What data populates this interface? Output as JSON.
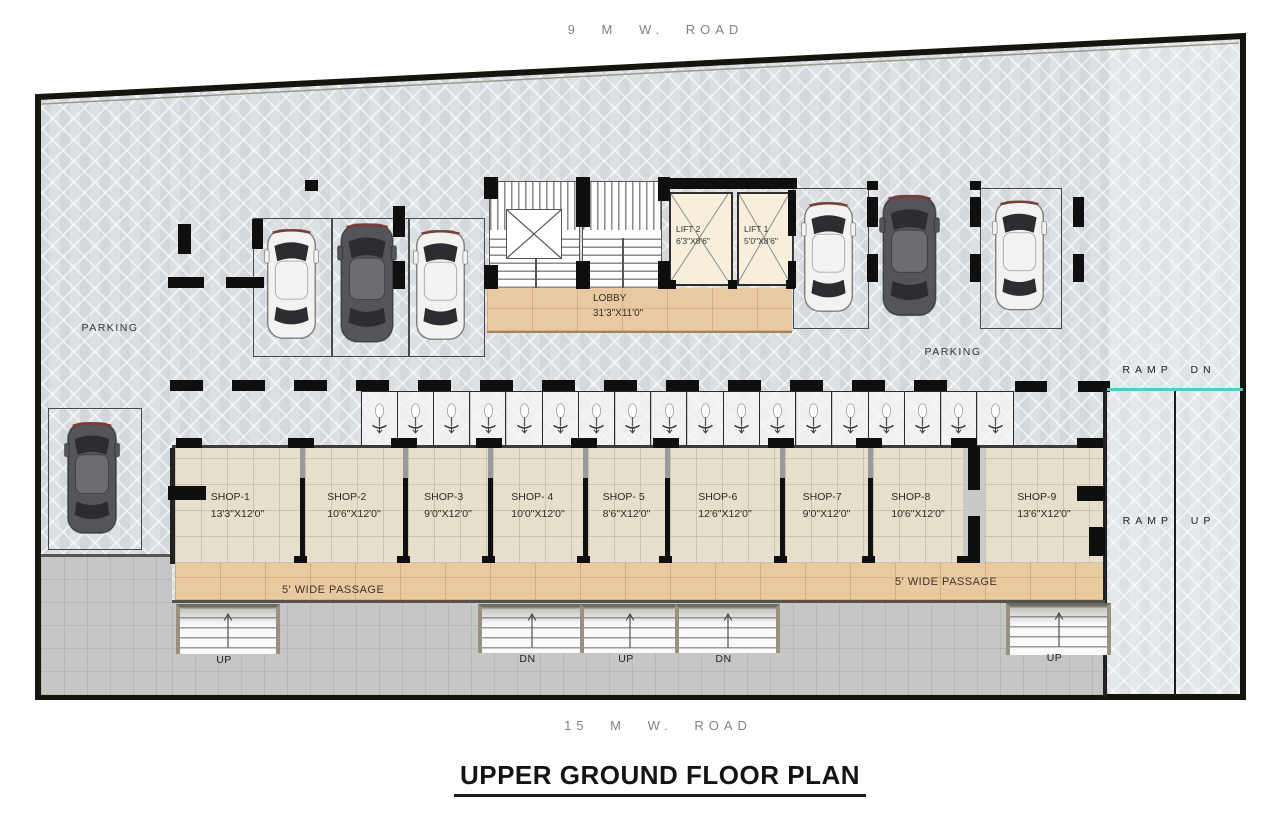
{
  "plan": {
    "title": "UPPER GROUND FLOOR PLAN",
    "road_top": "9 M W. ROAD",
    "road_bottom": "15 M W. ROAD",
    "parking_label_left": "PARKING",
    "parking_label_right": "PARKING",
    "ramp_down_label": "RAMP DN",
    "ramp_up_label": "RAMP UP",
    "passage_label_left": "5' WIDE PASSAGE",
    "passage_label_right": "5' WIDE PASSAGE",
    "lobby": {
      "name": "LOBBY",
      "dim": "31'3\"X11'0\""
    },
    "lifts": [
      {
        "name": "LIFT 2",
        "dim": "6'3\"X8'6\""
      },
      {
        "name": "LIFT 1",
        "dim": "5'0\"X8'6\""
      }
    ],
    "shops": [
      {
        "name": "SHOP-1",
        "dim": "13'3\"X12'0\""
      },
      {
        "name": "SHOP-2",
        "dim": "10'6\"X12'0\""
      },
      {
        "name": "SHOP-3",
        "dim": "9'0\"X12'0\""
      },
      {
        "name": "SHOP- 4",
        "dim": "10'0\"X12'0\""
      },
      {
        "name": "SHOP- 5",
        "dim": "8'6\"X12'0\""
      },
      {
        "name": "SHOP-6",
        "dim": "12'6\"X12'0\""
      },
      {
        "name": "SHOP-7",
        "dim": "9'0\"X12'0\""
      },
      {
        "name": "SHOP-8",
        "dim": "10'6\"X12'0\""
      },
      {
        "name": "SHOP-9",
        "dim": "13'6\"X12'0\""
      }
    ],
    "stair_labels": [
      "UP",
      "DN",
      "UP",
      "DN",
      "UP"
    ],
    "scooter_parking": {
      "count": 18
    },
    "cars": {
      "count": 7
    },
    "colors": {
      "teal_ramp_line": "#58c8c1",
      "shop_floor": "#e6dfcb",
      "passage_floor": "#e9c9a0",
      "lobby_floor": "#e8c9a2",
      "lift_floor": "#f7efdc",
      "parking_floor": "#dce0e3",
      "concrete": "#c6c7c5",
      "wall": "#0f0f0f"
    }
  }
}
